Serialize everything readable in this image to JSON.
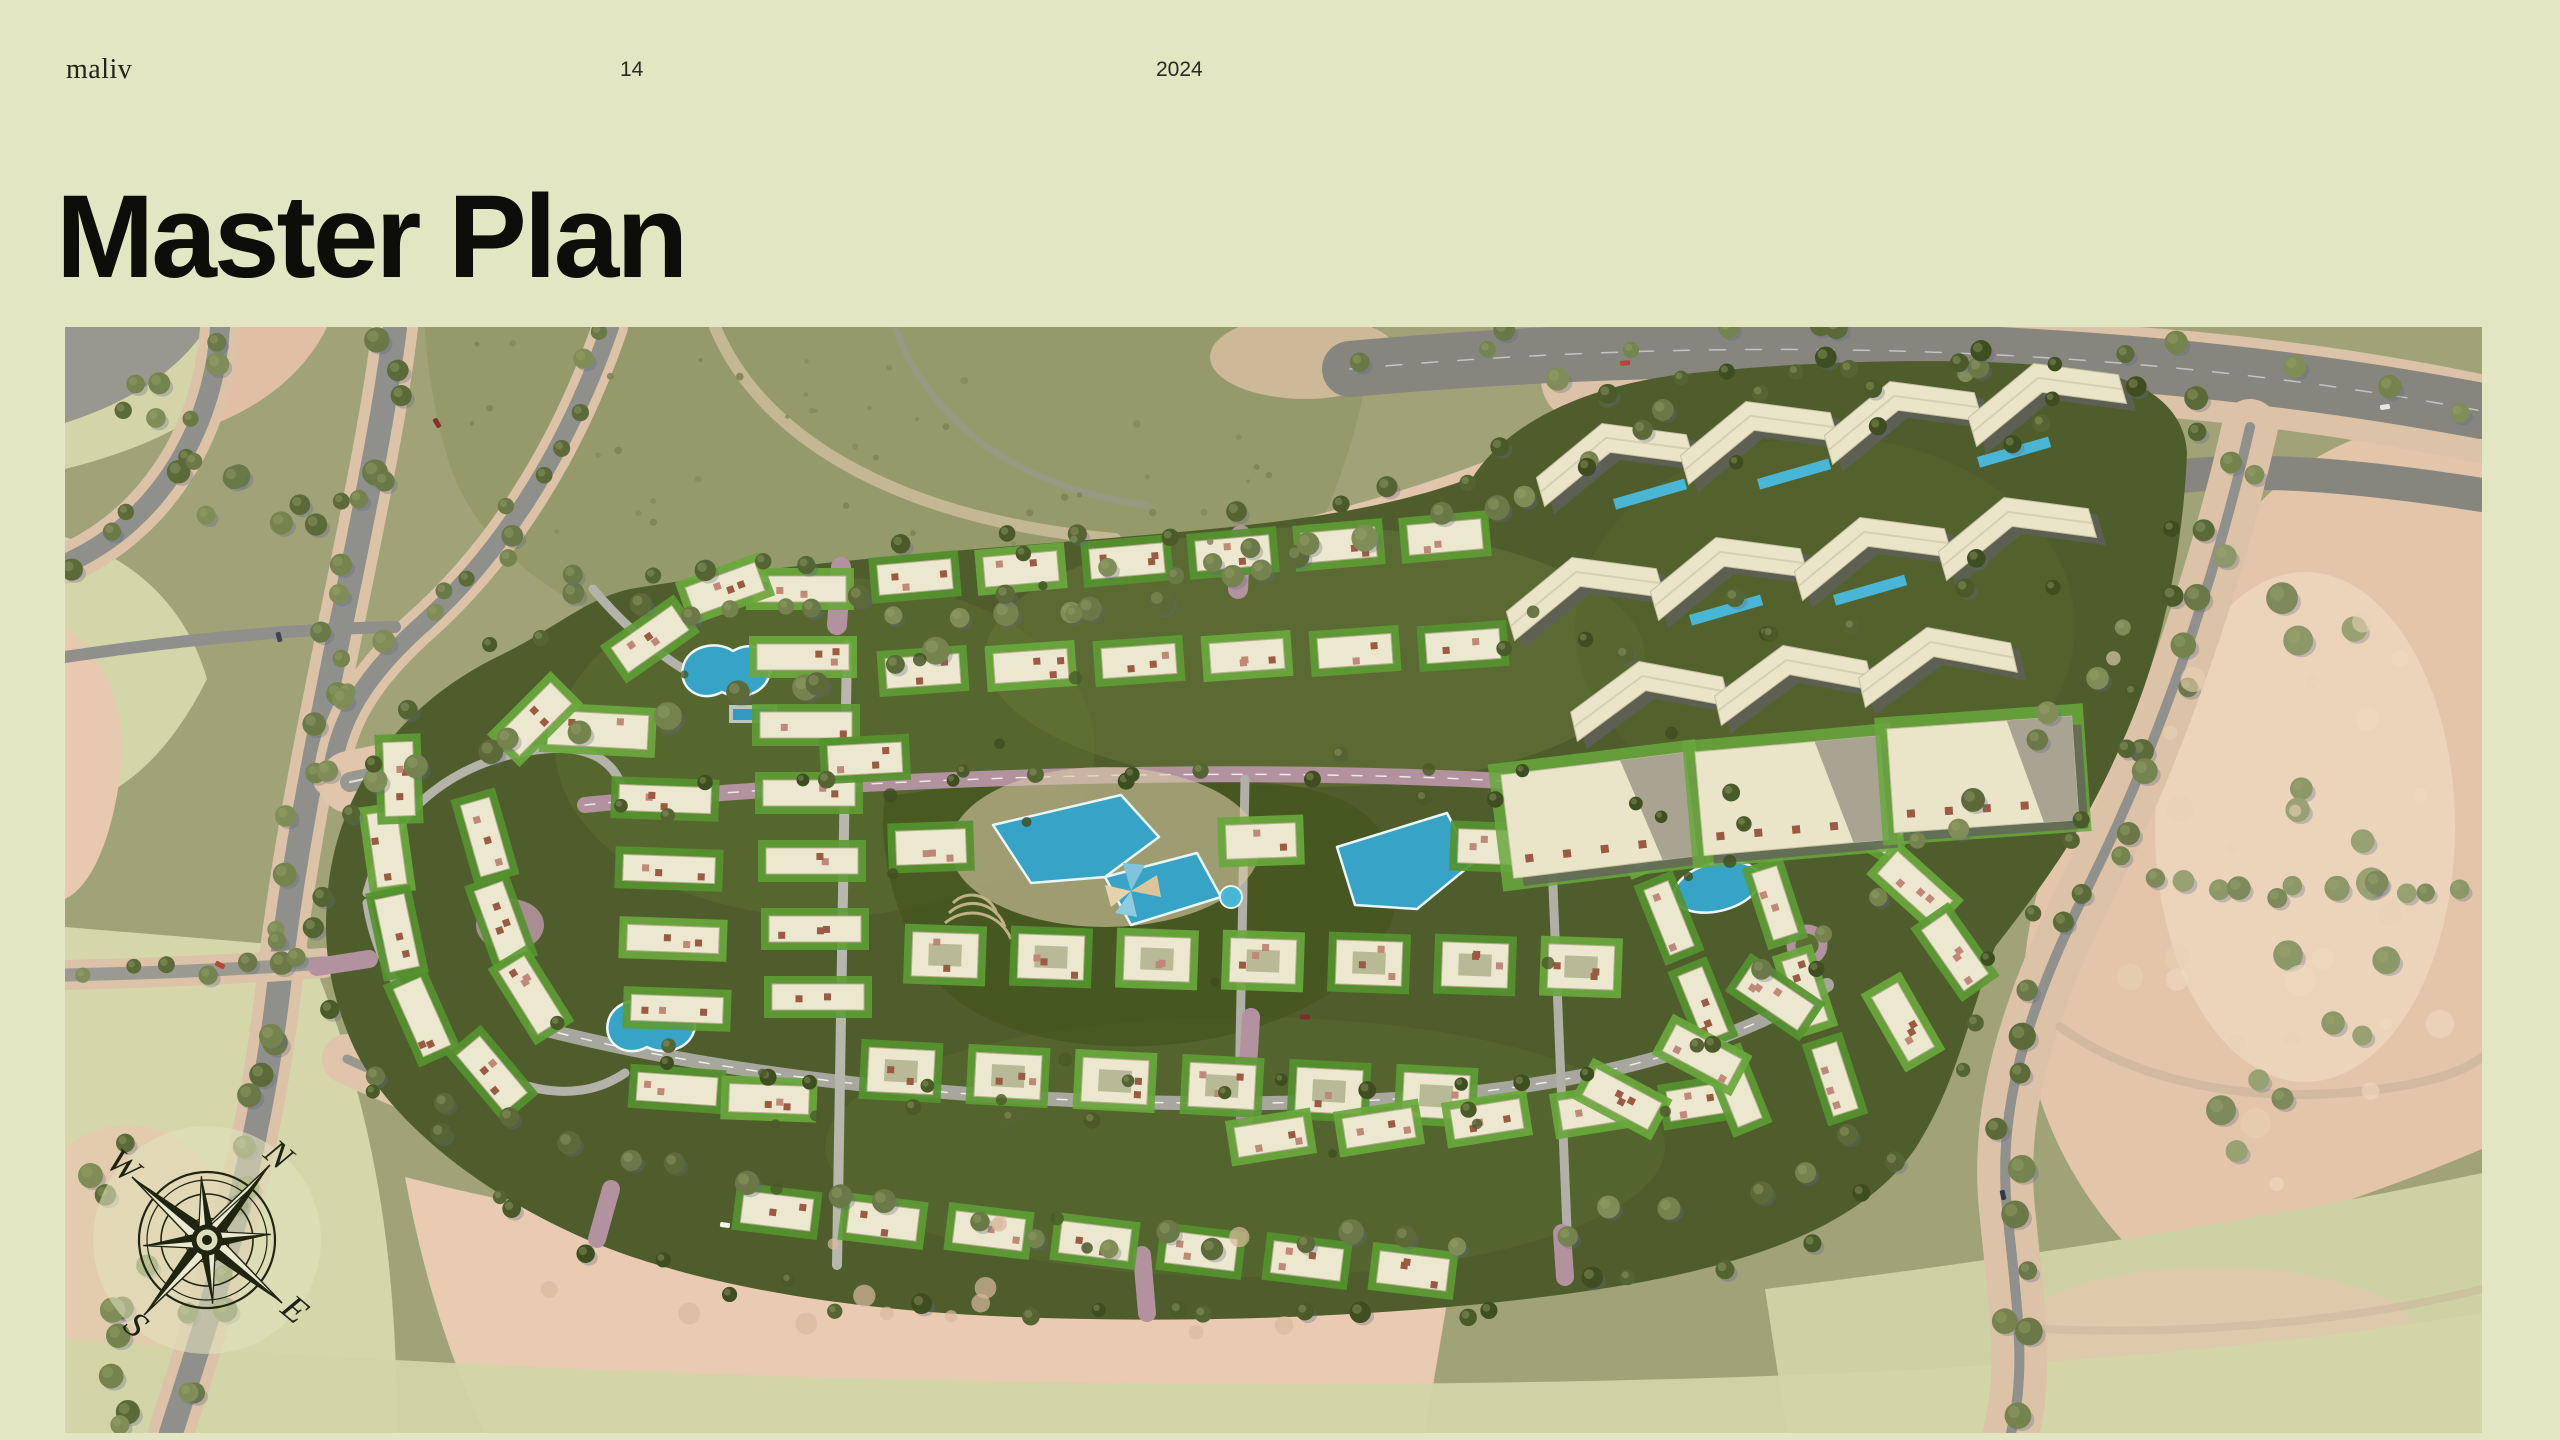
{
  "header": {
    "brand": "maliv",
    "page_number": "14",
    "year": "2024"
  },
  "title": "Master Plan",
  "compass": {
    "north": "N",
    "east": "E",
    "south": "S",
    "west": "W"
  },
  "palette": {
    "page_bg": "#e3e6c2",
    "ink": "#1b1b15",
    "map_base": "#a0a377",
    "field_green": "#949a69",
    "desert_sand": "#e3c5aa",
    "pale_sage": "#d6d8ab",
    "road_gray": "#8f8f8b",
    "compound_green": "#4e5d2b",
    "lawn_green": "#62a139",
    "building_cream": "#ece7cf",
    "pool_blue": "#36a3c7",
    "road_mauve": "#b2929f",
    "tree_olive": "#6e7a49"
  }
}
